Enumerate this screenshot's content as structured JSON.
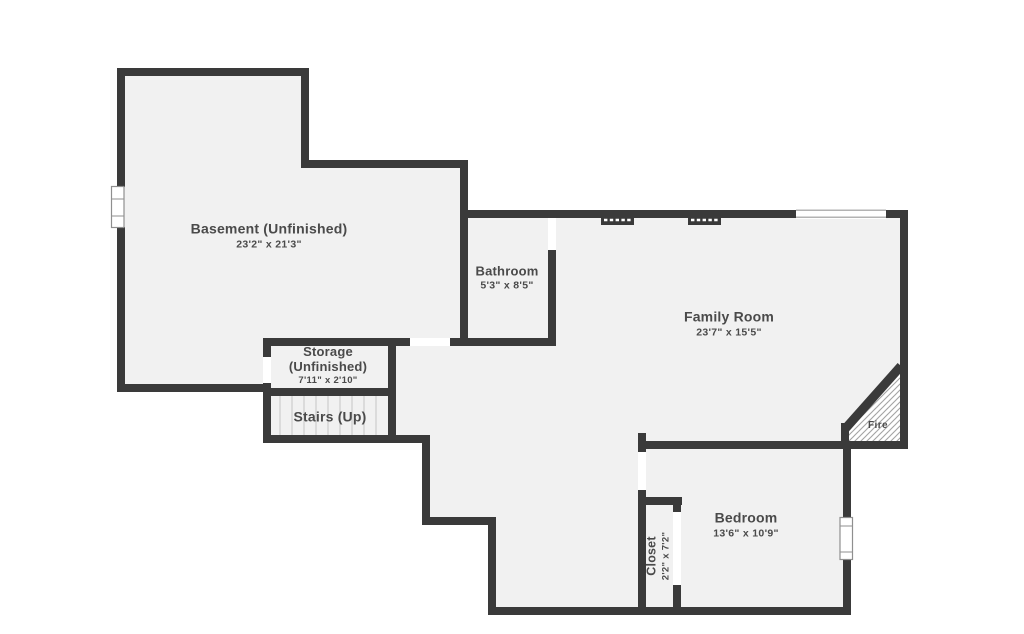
{
  "title": "Basement floor plan",
  "colors": {
    "wall": "#3a3a3a",
    "floor": "#f1f1f1",
    "outside": "#ffffff",
    "label": "#4a4a4a",
    "tread": "#d2d2d2",
    "window_stroke": "#8f8f8f",
    "hatch": "#a3a3a3"
  },
  "rooms": {
    "basement": {
      "name": "Basement (Unfinished)",
      "dims": "23'2\" x 21'3\""
    },
    "bathroom": {
      "name": "Bathroom",
      "dims": "5'3\" x 8'5\""
    },
    "family": {
      "name": "Family Room",
      "dims": "23'7\" x 15'5\""
    },
    "storage": {
      "name": "Storage",
      "name2": "(Unfinished)",
      "dims": "7'11\" x 2'10\""
    },
    "stairs": {
      "name": "Stairs (Up)"
    },
    "bedroom": {
      "name": "Bedroom",
      "dims": "13'6\" x 10'9\""
    },
    "closet": {
      "name": "Closet",
      "dims": "2'2\" x 7'2\""
    },
    "fireplace": {
      "name": "Fire"
    }
  }
}
